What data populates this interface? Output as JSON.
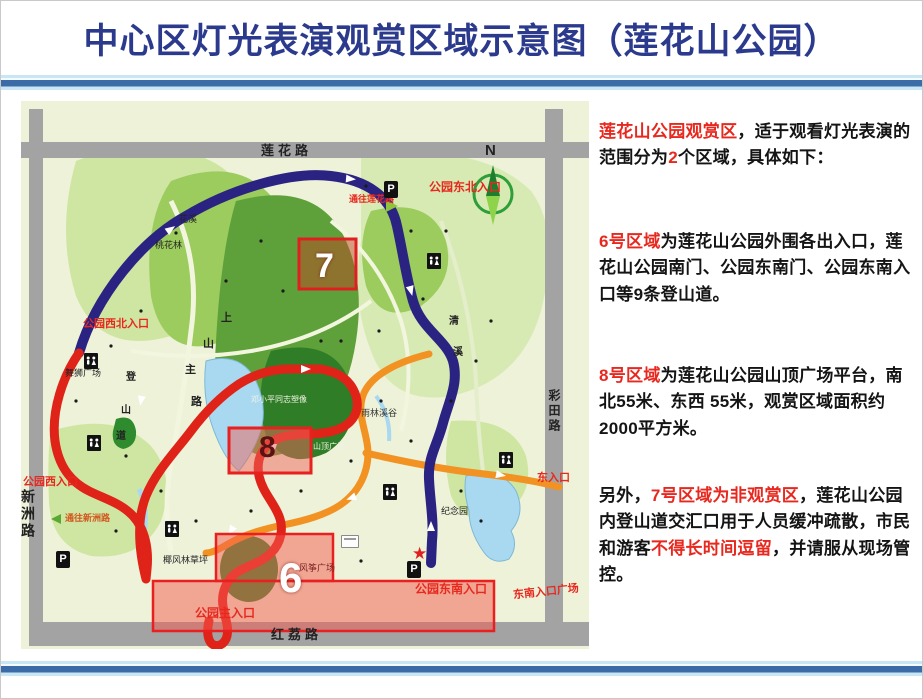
{
  "title": "中心区灯光表演观赏区域示意图（莲花山公园）",
  "info_panel": {
    "p1": {
      "red1": "莲花山公园观赏区",
      "black1": "，适于观看灯光表演的范围分为",
      "red2": "2",
      "black2": "个区域，具体如下："
    },
    "p2": {
      "red": "6号区域",
      "black": "为莲花山公园外围各出入口，莲花山公园南门、公园东南门、公园东南入口等9条登山道。"
    },
    "p3": {
      "red": "8号区域",
      "black": "为莲花山公园山顶广场平台，南北55米、东西 55米，观赏区域面积约2000平方米。"
    },
    "p4": {
      "black1": "另外，",
      "red1": "7号区域为非观赏区",
      "black2": "，莲花山公园内登山道交汇口用于人员缓冲疏散，市民和游客",
      "red2": "不得长时间逗留",
      "black3": "，并请服从现场管控。"
    }
  },
  "map": {
    "roads": {
      "top_label": "莲花路",
      "bottom_label": "红荔路",
      "left_label": "新洲路",
      "right_label": "彩田路"
    },
    "compass_n": "N",
    "zones": {
      "z6_number": "6",
      "z7_number": "7",
      "z8_number": "8"
    },
    "entrance_labels": {
      "northeast": "公园东北入口",
      "to_lianhua_road": "通往莲花路",
      "northwest": "公园西北入口",
      "west": "公园西入口",
      "east": "东入口",
      "southeast_square": "东南入口广场",
      "main": "公园主入口",
      "southeast": "公园东南入口",
      "to_xinzhou_road": "通往新洲路"
    },
    "place_labels": {
      "huaxi": "花溪",
      "taohualin": "桃花林",
      "wushi_square": "舞狮广场",
      "deng_statue": "邓小平同志塑像",
      "summit_square": "山顶广场",
      "rainforest_valley": "雨林溪谷",
      "memorial_garden": "纪念园",
      "coconut_lawn": "椰风林草坪",
      "kite_square": "风筝广场"
    },
    "path_chars": {
      "shang": "上",
      "shan": "山",
      "zhu": "主",
      "lu": "路",
      "deng": "登",
      "shan2": "山",
      "dao": "道",
      "qing": "清",
      "xi": "溪"
    },
    "icons": {
      "parking": "P",
      "star": "★"
    }
  },
  "colors": {
    "title_navy": "#2b3a8c",
    "accent_red": "#e8281e",
    "divider_blue": "#3c6ca8",
    "route_navy": "#2b2382",
    "route_red": "#e02318",
    "route_orange": "#f29222",
    "zone_fill": "rgba(245,90,80,0.5)"
  }
}
